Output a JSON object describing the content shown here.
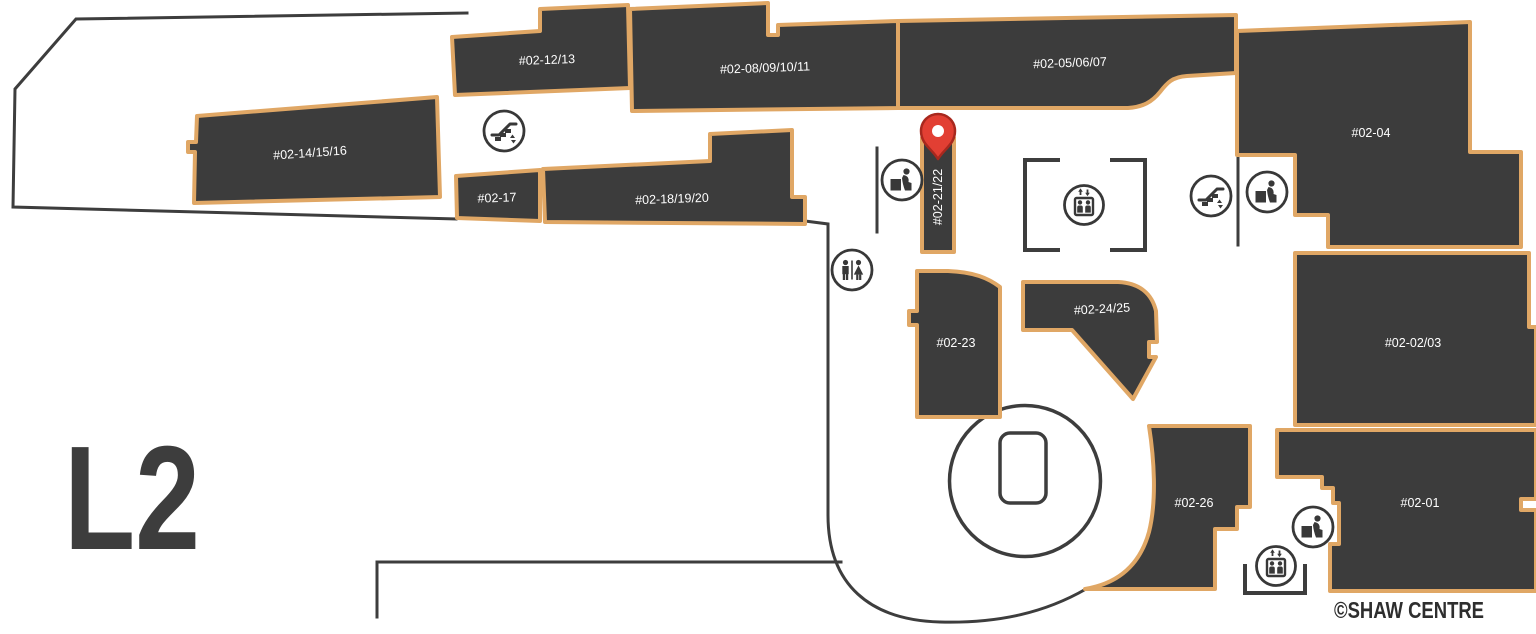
{
  "map": {
    "floor_label": "L2",
    "copyright": "©SHAW CENTRE",
    "location_pin_unit": "#02-21/22",
    "colors": {
      "unit_fill": "#3c3c3c",
      "unit_border": "#e0a765",
      "wall": "#3d3d3d",
      "unit_label": "#ffffff",
      "pin_fill": "#e23f33",
      "pin_border": "#a8281e",
      "floor_label_color": "#3d3d3d"
    },
    "units": [
      {
        "id": "unit-02-12-13",
        "label": "#02-12/13"
      },
      {
        "id": "unit-02-08-09-10-11",
        "label": "#02-08/09/10/11"
      },
      {
        "id": "unit-02-05-06-07",
        "label": "#02-05/06/07"
      },
      {
        "id": "unit-02-04",
        "label": "#02-04"
      },
      {
        "id": "unit-02-14-15-16",
        "label": "#02-14/15/16"
      },
      {
        "id": "unit-02-17",
        "label": "#02-17"
      },
      {
        "id": "unit-02-18-19-20",
        "label": "#02-18/19/20"
      },
      {
        "id": "unit-02-21-22",
        "label": "#02-21/22"
      },
      {
        "id": "unit-02-23",
        "label": "#02-23"
      },
      {
        "id": "unit-02-24-25",
        "label": "#02-24/25"
      },
      {
        "id": "unit-02-02-03",
        "label": "#02-02/03"
      },
      {
        "id": "unit-02-26",
        "label": "#02-26"
      },
      {
        "id": "unit-02-01",
        "label": "#02-01"
      }
    ],
    "icons": [
      "escalator-icon",
      "restroom-icon",
      "elevator-icon",
      "nursing-room-icon",
      "location-pin-icon"
    ]
  }
}
